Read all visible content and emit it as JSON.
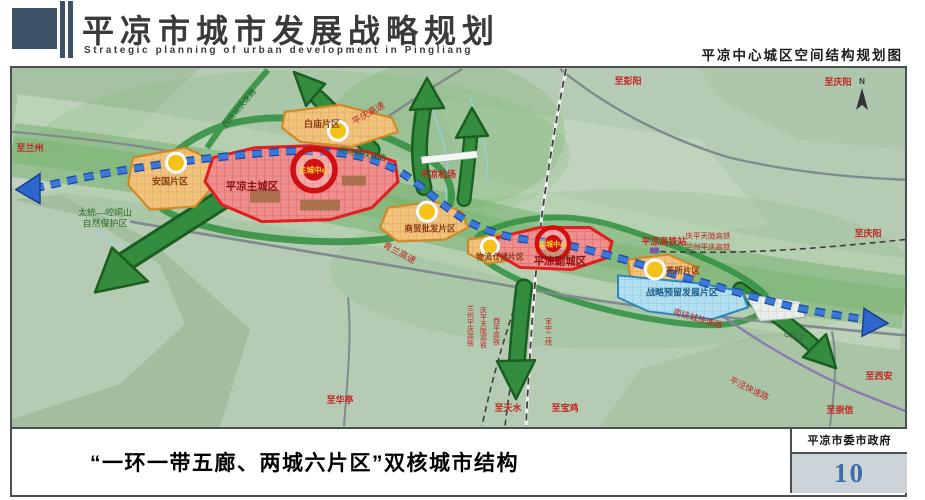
{
  "header": {
    "title": "平凉市城市发展战略规划",
    "subtitle": "Strategic planning of urban development in Pingliang",
    "map_title": "平凉中心城区空间结构规划图"
  },
  "map": {
    "compass": "N",
    "zones": [
      {
        "name": "白庙片区"
      },
      {
        "name": "安国片区"
      },
      {
        "name": "平凉主城区"
      },
      {
        "name": "商贸批发片区"
      },
      {
        "name": "物流仓储片区"
      },
      {
        "name": "平凉副城区"
      },
      {
        "name": "花所片区"
      },
      {
        "name": "战略预留发展片区"
      }
    ],
    "centers": [
      {
        "name": "主城中心"
      },
      {
        "name": "副城中心"
      }
    ],
    "nature_reserve": {
      "line1": "太统—崆峒山",
      "line2": "自然保护区"
    },
    "facilities": [
      {
        "name": "平凉机场"
      },
      {
        "name": "平凉高铁站"
      }
    ],
    "roads": [
      {
        "name": "西绕城快速路"
      },
      {
        "name": "平庆高速"
      },
      {
        "name": "北绕城快速路"
      },
      {
        "name": "青兰高速"
      },
      {
        "name": "南绕城快速路"
      },
      {
        "name": "G312"
      },
      {
        "name": "平泾快速路"
      }
    ],
    "railways": [
      {
        "name": "兰州平庆高铁"
      },
      {
        "name": "庆平天陇高铁"
      },
      {
        "name": "西平高铁"
      },
      {
        "name": "宝中二线"
      },
      {
        "name": "庆平天陇高铁"
      },
      {
        "name": "兰州平庆高铁"
      }
    ],
    "directions": [
      {
        "name": "至兰州"
      },
      {
        "name": "至彭阳"
      },
      {
        "name": "至庆阳"
      },
      {
        "name": "至庆阳"
      },
      {
        "name": "至西安"
      },
      {
        "name": "至崇信"
      },
      {
        "name": "至宝鸡"
      },
      {
        "name": "至天水"
      },
      {
        "name": "至华亭"
      }
    ]
  },
  "footer": {
    "caption": "“一环一带五廊、两城六片区”双核城市结构",
    "org": "平凉市委市政府",
    "page": "10"
  },
  "colors": {
    "corridor_green": "#348c3f",
    "zone_red_border": "#e02020",
    "zone_orange_border": "#d08a28",
    "axis_blue": "#2f66cc",
    "page_number_blue": "#3c6da6"
  }
}
